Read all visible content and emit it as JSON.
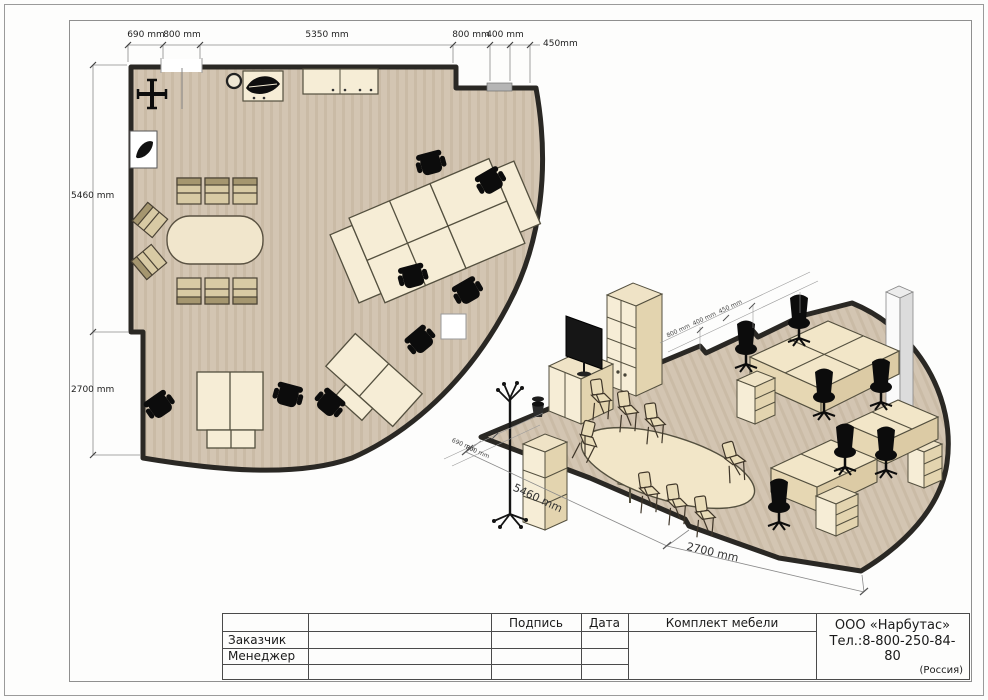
{
  "plan": {
    "dims_top": {
      "d690": "690 mm",
      "d800a": "800 mm",
      "d5350": "5350 mm",
      "d800b": "800 mm",
      "d400": "400 mm",
      "d450": "450mm"
    },
    "dims_left": {
      "d5460": "5460 mm",
      "d2700": "2700 mm"
    }
  },
  "iso": {
    "dims_bottom": {
      "d5460": "5460 mm",
      "d2700": "2700 mm"
    },
    "dims_small_left": [
      "690 mm",
      "800 mm"
    ],
    "dims_small_right": [
      "800 mm",
      "400 mm",
      "450 mm"
    ]
  },
  "title_block": {
    "col_signature": "Подпись",
    "col_date": "Дата",
    "col_set": "Комплект мебели",
    "row_customer": "Заказчик",
    "row_manager": "Менеджер",
    "company_name": "ООО «Нарбутас»",
    "company_phone": "Тел.:8-800-250-84-80",
    "company_country": "(Россия)"
  },
  "colors": {
    "floor": "#d3c5b2",
    "wall": "#2a2824",
    "furniture": "#f4e9cf",
    "chair_black": "#0c0c0c",
    "window_gray": "#b5b5b5",
    "dim_line": "#8a8a8a"
  }
}
